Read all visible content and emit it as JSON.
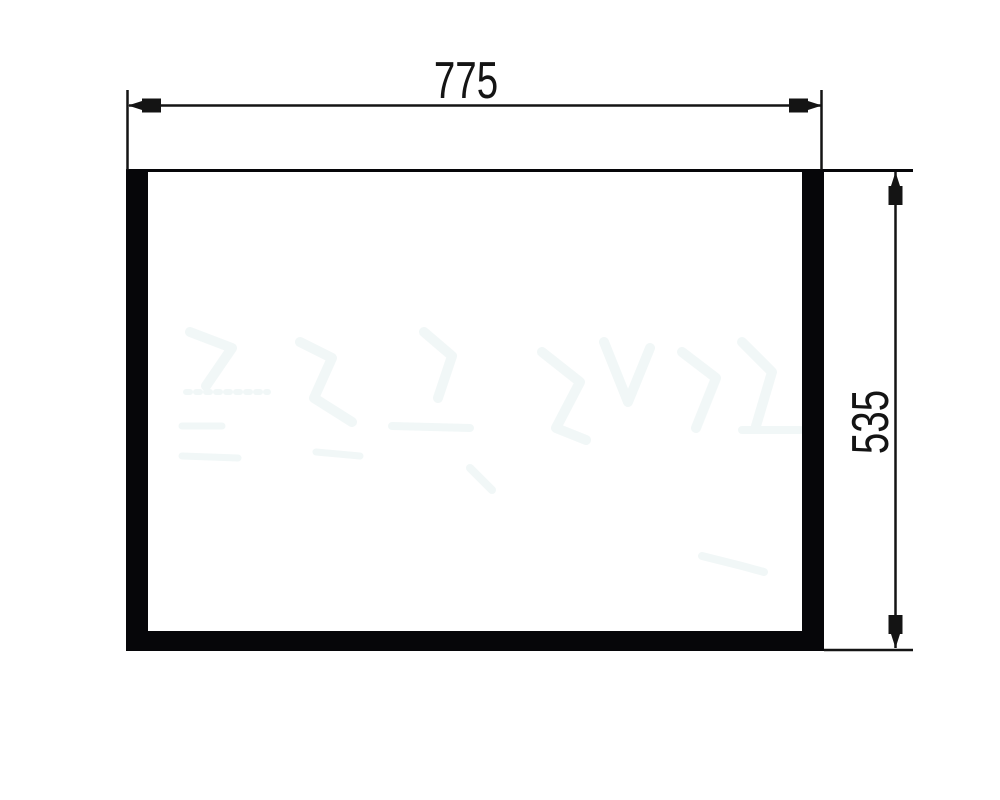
{
  "drawing": {
    "horizontal_dimension": "775",
    "vertical_dimension": "535"
  },
  "colors": {
    "background": "#ffffff",
    "ink": "#141414",
    "panel_fill": "#060609",
    "watermark": "#f1f7f7"
  }
}
